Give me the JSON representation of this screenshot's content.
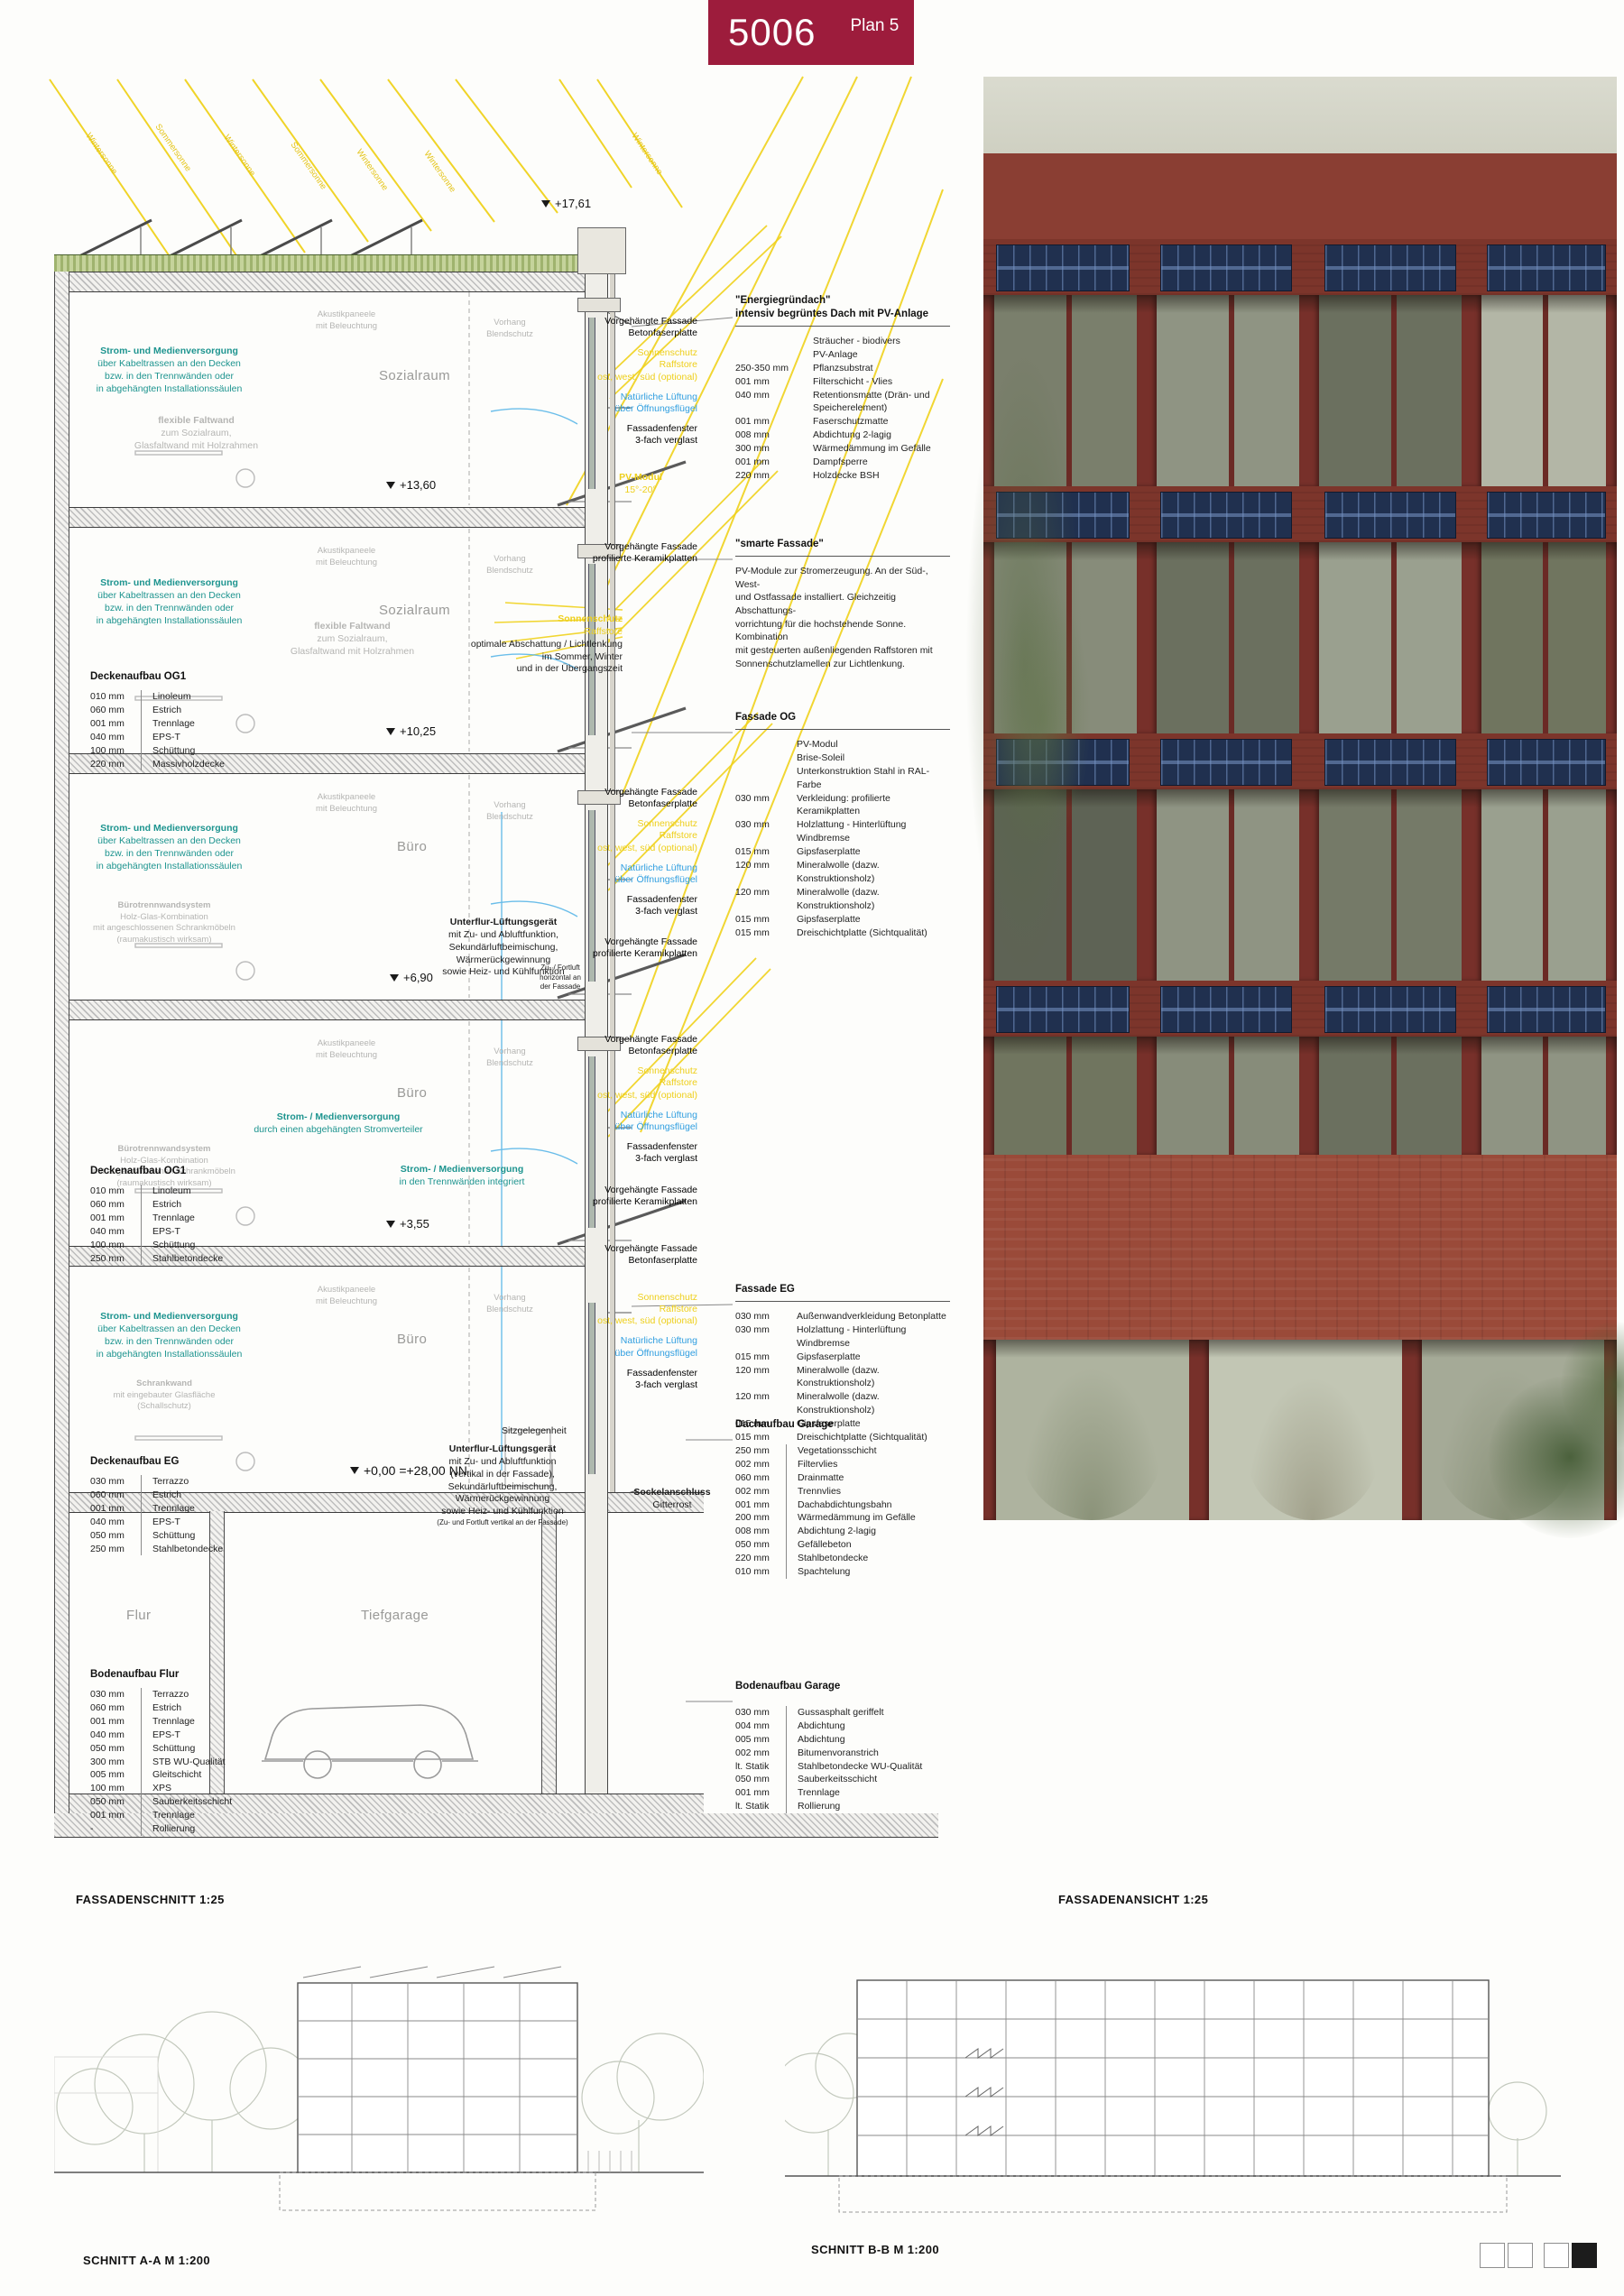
{
  "header": {
    "number": "5006",
    "plan_label": "Plan 5"
  },
  "footer": {
    "fassadenschnitt": "FASSADENSCHNITT 1:25",
    "fassadenansicht": "FASSADENANSICHT 1:25",
    "schnitt_aa": "SCHNITT A-A M 1:200",
    "schnitt_bb": "SCHNITT B-B M 1:200"
  },
  "levels": {
    "roof": "+17,61",
    "og3": "+13,60",
    "og2": "+10,25",
    "og1": "+6,90",
    "eg_upper": "+3,55",
    "eg": "+0,00 =+28,00 NN"
  },
  "rooms": {
    "sozialraum": "Sozialraum",
    "buero": "Büro",
    "flur": "Flur",
    "tiefgarage": "Tiefgarage"
  },
  "sun": {
    "winter": "Wintersonne",
    "sommer": "Sommersonne"
  },
  "teal_supply": {
    "title": "Strom- und Medienversorgung",
    "lines": [
      "über Kabeltrassen an den Decken",
      "bzw. in den Trennwänden oder",
      "in abgehängten Installationssäulen"
    ]
  },
  "teal_distributor": {
    "title": "Strom- / Medienversorgung",
    "lines": [
      "durch einen abgehängten Stromverteiler"
    ]
  },
  "teal_partition": {
    "title": "Strom- / Medienversorgung",
    "lines": [
      "in den Trennwänden integriert"
    ]
  },
  "gray_faltwand": {
    "title": "flexible Faltwand",
    "lines": [
      "zum Sozialraum,",
      "Glasfaltwand mit Holzrahmen"
    ]
  },
  "gray_trennwand": {
    "title": "Bürotrennwandsystem",
    "lines": [
      "Holz-Glas-Kombination",
      "mit angeschlossenen Schrankmöbeln",
      "(raumakustisch wirksam)"
    ]
  },
  "gray_schrankwand": {
    "title": "Schrankwand",
    "lines": [
      "mit eingebauter Glasfläche",
      "(Schallschutz)"
    ]
  },
  "gray_akustik": {
    "lines": [
      "Akustikpaneele",
      "mit Beleuchtung"
    ]
  },
  "gray_vorhang": {
    "lines": [
      "Vorhang",
      "Blendschutz"
    ]
  },
  "facade_labels": {
    "vf_beton": {
      "title": "Vorgehängte Fassade",
      "lines": [
        "Betonfaserplatte"
      ]
    },
    "vf_keramik": {
      "title": "Vorgehängte Fassade",
      "lines": [
        "profilierte Keramikplatten"
      ]
    },
    "fenster": {
      "title": "Fassadenfenster",
      "lines": [
        "3-fach verglast"
      ]
    },
    "lueftung": {
      "title": "Natürliche Lüftung",
      "lines": [
        "über Öffnungsflügel"
      ]
    },
    "sonnenschutz": {
      "title": "Sonnenschutz",
      "lines": [
        "Raffstore",
        "ost, west, süd (optional)"
      ]
    },
    "sonnenschutz_og": {
      "title": "Sonnenschutz",
      "lines": [
        "Raffstore"
      ]
    },
    "sonnenschutz_text": {
      "lines": [
        "optimale Abschattung / Lichtlenkung",
        "im Sommer, Winter",
        "und in der Übergangszeit"
      ]
    },
    "pv_modul": {
      "title": "PV-Modul",
      "lines": [
        "15°-20°"
      ]
    },
    "lueftungsgeraet": {
      "title": "Unterflur-Lüftungsgerät",
      "lines": [
        "mit Zu- und Abluftfunktion,",
        "Sekundärluftbeimischung,",
        "Wärmerückgewinnung",
        "sowie Heiz- und Kühlfunktion"
      ]
    },
    "lueftungsgeraet_eg": {
      "title": "Unterflur-Lüftungsgerät",
      "lines": [
        "mit Zu- und Abluftfunktion",
        "(vertikal in der Fassade),",
        "Sekundärluftbeimischung,",
        "Wärmerückgewinnung",
        "sowie Heiz- und Kühlfunktion"
      ],
      "foot": "(Zu- und Fortluft vertikal an der Fassade)"
    },
    "zufortluft": {
      "lines": [
        "Zu- / Fortluft",
        "horizontal an",
        "der Fassade"
      ]
    },
    "sitz": "Sitzgelegenheit",
    "sockel": {
      "title": "Sockelanschluss",
      "lines": [
        "Gitterrost"
      ]
    }
  },
  "right_notes": {
    "energie": {
      "title": "\"Energiegründach\"",
      "subtitle": "intensiv begrüntes Dach mit PV-Anlage",
      "rows": [
        [
          "",
          "Sträucher - biodivers"
        ],
        [
          "",
          "PV-Anlage"
        ],
        [
          "250-350 mm",
          "Pflanzsubstrat"
        ],
        [
          "001 mm",
          "Filterschicht - Vlies"
        ],
        [
          "040 mm",
          "Retentionsmatte (Drän- und Speicherelement)"
        ],
        [
          "001 mm",
          "Faserschutzmatte"
        ],
        [
          "008 mm",
          "Abdichtung 2-lagig"
        ],
        [
          "300 mm",
          "Wärmedämmung im Gefälle"
        ],
        [
          "001 mm",
          "Dampfsperre"
        ],
        [
          "220 mm",
          "Holzdecke BSH"
        ]
      ]
    },
    "smarte": {
      "title": "\"smarte Fassade\"",
      "para": [
        "PV-Module zur Stromerzeugung. An der Süd-, West-",
        "und Ostfassade installiert. Gleichzeitig Abschattungs-",
        "vorrichtung für die hochstehende Sonne. Kombination",
        "mit gesteuerten außenliegenden Raffstoren mit",
        "Sonnenschutzlamellen zur Lichtlenkung."
      ]
    },
    "fassade_og": {
      "title": "Fassade OG",
      "rows": [
        [
          "",
          "PV-Modul"
        ],
        [
          "",
          "Brise-Soleil"
        ],
        [
          "",
          "Unterkonstruktion Stahl in RAL-Farbe"
        ],
        [
          "030 mm",
          "Verkleidung: profilierte Keramikplatten"
        ],
        [
          "030 mm",
          "Holzlattung - Hinterlüftung"
        ],
        [
          "",
          "Windbremse"
        ],
        [
          "015 mm",
          "Gipsfaserplatte"
        ],
        [
          "120 mm",
          "Mineralwolle (dazw. Konstruktionsholz)"
        ],
        [
          "120 mm",
          "Mineralwolle (dazw. Konstruktionsholz)"
        ],
        [
          "015 mm",
          "Gipsfaserplatte"
        ],
        [
          "015 mm",
          "Dreischichtplatte (Sichtqualität)"
        ]
      ]
    },
    "fassade_eg": {
      "title": "Fassade EG",
      "rows": [
        [
          "030 mm",
          "Außenwandverkleidung Betonplatte"
        ],
        [
          "030 mm",
          "Holzlattung - Hinterlüftung"
        ],
        [
          "",
          "Windbremse"
        ],
        [
          "015 mm",
          "Gipsfaserplatte"
        ],
        [
          "120 mm",
          "Mineralwolle (dazw. Konstruktionsholz)"
        ],
        [
          "120 mm",
          "Mineralwolle (dazw. Konstruktionsholz)"
        ],
        [
          "015 mm",
          "Gipsfaserplatte"
        ],
        [
          "015 mm",
          "Dreischichtplatte (Sichtqualität)"
        ]
      ]
    },
    "dach_garage": {
      "title": "Dachaufbau Garage",
      "rows": [
        [
          "250 mm",
          "Vegetationsschicht"
        ],
        [
          "002 mm",
          "Filtervlies"
        ],
        [
          "060 mm",
          "Drainmatte"
        ],
        [
          "002 mm",
          "Trennvlies"
        ],
        [
          "001 mm",
          "Dachabdichtungsbahn"
        ],
        [
          "200 mm",
          "Wärmedämmung im Gefälle"
        ],
        [
          "008 mm",
          "Abdichtung 2-lagig"
        ],
        [
          "050 mm",
          "Gefällebeton"
        ],
        [
          "220 mm",
          "Stahlbetondecke"
        ],
        [
          "010 mm",
          "Spachtelung"
        ]
      ]
    },
    "boden_garage": {
      "title": "Bodenaufbau Garage",
      "rows": [
        [
          "030 mm",
          "Gussasphalt geriffelt"
        ],
        [
          "004 mm",
          "Abdichtung"
        ],
        [
          "005 mm",
          "Abdichtung"
        ],
        [
          "002 mm",
          "Bitumenvoranstrich"
        ],
        [
          "lt. Statik",
          "Stahlbetondecke WU-Qualität"
        ],
        [
          "050 mm",
          "Sauberkeitsschicht"
        ],
        [
          "001 mm",
          "Trennlage"
        ],
        [
          "lt. Statik",
          "Rollierung"
        ]
      ]
    }
  },
  "left_lists": {
    "decke_og1_a": {
      "title": "Deckenaufbau OG1",
      "rows": [
        [
          "010 mm",
          "Linoleum"
        ],
        [
          "060 mm",
          "Estrich"
        ],
        [
          "001 mm",
          "Trennlage"
        ],
        [
          "040 mm",
          "EPS-T"
        ],
        [
          "100 mm",
          "Schüttung"
        ],
        [
          "220 mm",
          "Massivholzdecke"
        ]
      ]
    },
    "decke_og1_b": {
      "title": "Deckenaufbau OG1",
      "rows": [
        [
          "010 mm",
          "Linoleum"
        ],
        [
          "060 mm",
          "Estrich"
        ],
        [
          "001 mm",
          "Trennlage"
        ],
        [
          "040 mm",
          "EPS-T"
        ],
        [
          "100 mm",
          "Schüttung"
        ],
        [
          "250 mm",
          "Stahlbetondecke"
        ]
      ]
    },
    "decke_eg": {
      "title": "Deckenaufbau EG",
      "rows": [
        [
          "030 mm",
          "Terrazzo"
        ],
        [
          "060 mm",
          "Estrich"
        ],
        [
          "001 mm",
          "Trennlage"
        ],
        [
          "040 mm",
          "EPS-T"
        ],
        [
          "050 mm",
          "Schüttung"
        ],
        [
          "250 mm",
          "Stahlbetondecke"
        ]
      ]
    },
    "boden_flur": {
      "title": "Bodenaufbau Flur",
      "rows": [
        [
          "030 mm",
          "Terrazzo"
        ],
        [
          "060 mm",
          "Estrich"
        ],
        [
          "001 mm",
          "Trennlage"
        ],
        [
          "040 mm",
          "EPS-T"
        ],
        [
          "050 mm",
          "Schüttung"
        ],
        [
          "300 mm",
          "STB WU-Qualität"
        ],
        [
          "005 mm",
          "Gleitschicht"
        ],
        [
          "100 mm",
          "XPS"
        ],
        [
          "050 mm",
          "Sauberkeitsschicht"
        ],
        [
          "001 mm",
          "Trennlage"
        ],
        [
          "-",
          "Rollierung"
        ]
      ]
    }
  },
  "colors": {
    "title_red": "#9d1c3c",
    "teal": "#1d948f",
    "sun_yellow": "#eecf1b",
    "vent_blue": "#2f9ee0",
    "pv_navy": "#20304f",
    "facade_red": "#8a3e33"
  }
}
